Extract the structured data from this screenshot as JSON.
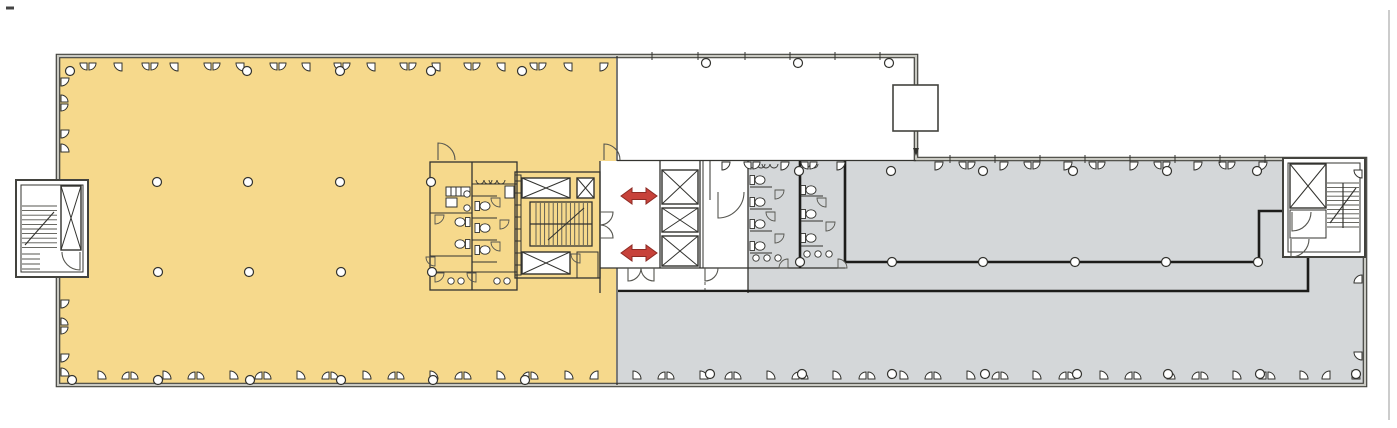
{
  "document": {
    "kind": "architectural-floor-plan",
    "visible_text": [],
    "zones": [
      {
        "id": "west-office-zone",
        "fill": "zone_yellow"
      },
      {
        "id": "east-office-zone",
        "fill": "zone_gray"
      }
    ]
  },
  "colors": {
    "paper": "#ffffff",
    "zone_yellow": "#f6d98c",
    "zone_gray": "#d4d7d9",
    "wall_dark": "#43433e",
    "wall_light": "#c9c9c2",
    "line": "#33332f",
    "line_soft": "#55554f",
    "thick": "#1c1c1a",
    "arrow_red": "#c7423a",
    "arrow_red_dark": "#8e2b24",
    "scan_gray": "#cccccc"
  },
  "markers": {
    "arrows": {
      "positions": [
        {
          "x": 639,
          "y": 196
        },
        {
          "x": 639,
          "y": 253
        }
      ],
      "half_len": 18,
      "head_len": 11,
      "shaft_half": 3.5,
      "head_half": 8
    },
    "columns": {
      "r": 4.5,
      "rows": [
        {
          "y": 71,
          "xs": [
            70,
            247,
            340,
            431,
            522
          ]
        },
        {
          "y": 182,
          "xs": [
            157,
            248,
            340,
            431
          ]
        },
        {
          "y": 272,
          "xs": [
            158,
            249,
            341,
            432
          ]
        },
        {
          "y": 380,
          "xs": [
            72,
            158,
            250,
            341,
            433,
            525
          ]
        },
        {
          "y": 63,
          "xs": [
            706,
            798,
            889
          ]
        },
        {
          "y": 171,
          "xs": [
            799,
            891,
            983,
            1073,
            1167,
            1257
          ]
        },
        {
          "y": 262,
          "xs": [
            800,
            892,
            983,
            1075,
            1166,
            1258
          ]
        },
        {
          "y": 374,
          "xs": [
            710,
            802,
            892,
            985,
            1077,
            1168,
            1260,
            1356
          ]
        }
      ]
    },
    "windows": {
      "r_single": 8,
      "r_pair": 7,
      "walls": [
        {
          "dir": "down",
          "y": 63,
          "marks": [
            [
              88,
              2
            ],
            [
              122,
              1
            ],
            [
              150,
              2
            ],
            [
              178,
              1
            ],
            [
              212,
              2
            ],
            [
              244,
              1
            ],
            [
              278,
              2
            ],
            [
              310,
              1
            ],
            [
              342,
              2
            ],
            [
              375,
              1
            ],
            [
              408,
              2
            ],
            [
              440,
              1
            ],
            [
              472,
              2
            ],
            [
              505,
              1
            ],
            [
              538,
              2
            ],
            [
              572,
              1
            ],
            [
              600,
              1
            ]
          ]
        },
        {
          "dir": "up",
          "y": 379,
          "marks": [
            [
              98,
              1
            ],
            [
              130,
              2
            ],
            [
              163,
              1
            ],
            [
              196,
              2
            ],
            [
              230,
              1
            ],
            [
              263,
              2
            ],
            [
              297,
              1
            ],
            [
              330,
              2
            ],
            [
              363,
              1
            ],
            [
              396,
              2
            ],
            [
              430,
              1
            ],
            [
              463,
              2
            ],
            [
              497,
              1
            ],
            [
              530,
              2
            ],
            [
              565,
              1
            ],
            [
              598,
              1
            ]
          ]
        },
        {
          "dir": "up",
          "y": 379,
          "marks": [
            [
              633,
              1
            ],
            [
              666,
              2
            ],
            [
              700,
              1
            ],
            [
              733,
              2
            ],
            [
              767,
              1
            ],
            [
              800,
              2
            ],
            [
              833,
              1
            ],
            [
              867,
              2
            ],
            [
              900,
              1
            ],
            [
              933,
              2
            ],
            [
              967,
              1
            ],
            [
              1000,
              2
            ],
            [
              1033,
              1
            ],
            [
              1067,
              2
            ],
            [
              1100,
              1
            ],
            [
              1133,
              2
            ],
            [
              1167,
              1
            ],
            [
              1200,
              2
            ],
            [
              1233,
              1
            ],
            [
              1267,
              2
            ],
            [
              1300,
              1
            ],
            [
              1330,
              1
            ],
            [
              1352,
              1
            ]
          ]
        },
        {
          "dir": "down",
          "y": 162,
          "marks": [
            [
              935,
              1
            ],
            [
              967,
              2
            ],
            [
              1000,
              1
            ],
            [
              1032,
              2
            ],
            [
              1064,
              1
            ],
            [
              1097,
              2
            ],
            [
              1130,
              1
            ],
            [
              1162,
              2
            ],
            [
              1194,
              1
            ],
            [
              1227,
              2
            ],
            [
              1259,
              1
            ]
          ]
        },
        {
          "dir": "down",
          "y": 162,
          "marks": [
            [
              722,
              1
            ],
            [
              752,
              2
            ],
            [
              781,
              1
            ],
            [
              809,
              2
            ],
            [
              837,
              1
            ]
          ]
        },
        {
          "dir": "right",
          "x": 61,
          "marks": [
            [
              78,
              1
            ],
            [
              103,
              2
            ],
            [
              130,
              1
            ],
            [
              152,
              1
            ],
            [
              300,
              1
            ],
            [
              326,
              2
            ],
            [
              354,
              1
            ],
            [
              376,
              1
            ]
          ]
        },
        {
          "dir": "left",
          "x": 1362,
          "marks": [
            [
              170,
              1
            ],
            [
              283,
              1
            ],
            [
              352,
              1
            ]
          ]
        }
      ]
    },
    "wall_ticks": [
      {
        "y": 56,
        "xs": [
          652,
          698,
          745,
          790,
          835,
          880
        ]
      },
      {
        "y": 159,
        "xs": [
          950,
          995,
          1040,
          1085,
          1130,
          1175,
          1220,
          1265
        ]
      }
    ],
    "stairs": {
      "flights": [
        {
          "orient": "v",
          "x1": 536,
          "x2": 588,
          "y1": 203,
          "y2": 245,
          "step": 4.3
        },
        {
          "orient": "h",
          "x1": 1327,
          "x2": 1359,
          "y1": 183,
          "y2": 228,
          "step": 4.4
        },
        {
          "orient": "h",
          "x1": 22,
          "x2": 57,
          "y1": 206,
          "y2": 250,
          "step": 4.6
        },
        {
          "orient": "h",
          "x1": 22,
          "x2": 40,
          "y1": 254,
          "y2": 270,
          "step": 5.0
        }
      ],
      "dividers": [
        [
          530,
          224,
          592,
          224
        ],
        [
          1343,
          183,
          1343,
          228
        ]
      ],
      "arrows": [
        [
          548,
          240,
          584,
          208
        ],
        [
          1330,
          223,
          1356,
          188
        ],
        [
          25,
          245,
          54,
          212
        ]
      ]
    },
    "elevators": [
      {
        "x": 522,
        "y": 178,
        "w": 48,
        "h": 20
      },
      {
        "x": 577,
        "y": 178,
        "w": 17,
        "h": 20
      },
      {
        "x": 522,
        "y": 252,
        "w": 48,
        "h": 22
      },
      {
        "x": 662,
        "y": 170,
        "w": 36,
        "h": 34
      },
      {
        "x": 662,
        "y": 208,
        "w": 36,
        "h": 24
      },
      {
        "x": 662,
        "y": 236,
        "w": 36,
        "h": 30
      },
      {
        "x": 1290,
        "y": 164,
        "w": 36,
        "h": 44
      },
      {
        "x": 61,
        "y": 186,
        "w": 20,
        "h": 64
      }
    ],
    "toilets": [
      {
        "x": 483,
        "y": 206,
        "dir": 1
      },
      {
        "x": 483,
        "y": 228,
        "dir": 1
      },
      {
        "x": 483,
        "y": 250,
        "dir": 1
      },
      {
        "x": 462,
        "y": 222,
        "dir": -1
      },
      {
        "x": 462,
        "y": 244,
        "dir": -1
      },
      {
        "x": 758,
        "y": 180,
        "dir": 1
      },
      {
        "x": 758,
        "y": 202,
        "dir": 1
      },
      {
        "x": 758,
        "y": 224,
        "dir": 1
      },
      {
        "x": 758,
        "y": 246,
        "dir": 1
      },
      {
        "x": 809,
        "y": 190,
        "dir": 1
      },
      {
        "x": 809,
        "y": 214,
        "dir": 1
      },
      {
        "x": 809,
        "y": 238,
        "dir": 1
      }
    ],
    "sinks": {
      "r": 3.2,
      "points": [
        [
          451,
          281
        ],
        [
          461,
          281
        ],
        [
          497,
          281
        ],
        [
          507,
          281
        ],
        [
          467,
          194
        ],
        [
          467,
          208
        ],
        [
          756,
          258
        ],
        [
          767,
          258
        ],
        [
          778,
          258
        ],
        [
          807,
          254
        ],
        [
          818,
          254
        ],
        [
          829,
          254
        ]
      ]
    },
    "urinals": [
      [
        484,
        180
      ],
      [
        497,
        180
      ],
      [
        757,
        164
      ],
      [
        770,
        164
      ],
      [
        810,
        164
      ]
    ],
    "stall_fans": [
      {
        "x": 500,
        "y": 198,
        "dir": "down"
      },
      {
        "x": 500,
        "y": 220,
        "dir": "down"
      },
      {
        "x": 500,
        "y": 242,
        "dir": "down"
      },
      {
        "x": 435,
        "y": 215,
        "dir": "down"
      },
      {
        "x": 435,
        "y": 257,
        "dir": "down"
      },
      {
        "x": 435,
        "y": 273,
        "dir": "down"
      },
      {
        "x": 476,
        "y": 273,
        "dir": "down"
      },
      {
        "x": 775,
        "y": 190,
        "dir": "down"
      },
      {
        "x": 775,
        "y": 212,
        "dir": "down"
      },
      {
        "x": 775,
        "y": 234,
        "dir": "down"
      },
      {
        "x": 826,
        "y": 198,
        "dir": "down"
      },
      {
        "x": 826,
        "y": 222,
        "dir": "down"
      },
      {
        "x": 788,
        "y": 268,
        "dir": "up"
      },
      {
        "x": 838,
        "y": 268,
        "dir": "up"
      },
      {
        "x": 580,
        "y": 254,
        "dir": "down"
      }
    ]
  }
}
